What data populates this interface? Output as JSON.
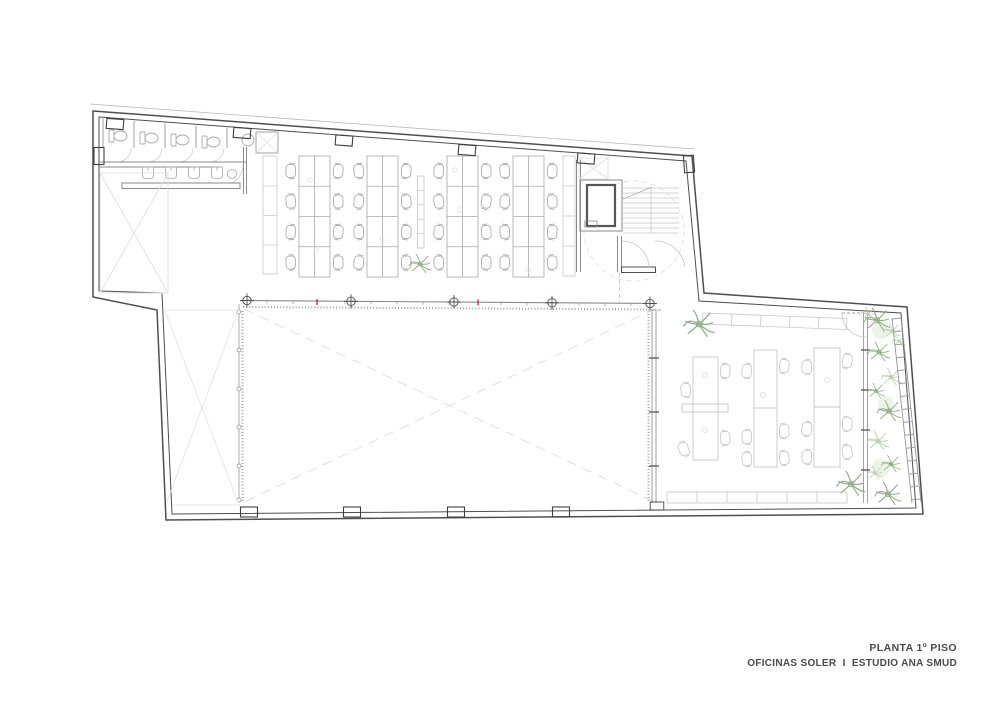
{
  "title_block": {
    "line1": "PLANTA 1º PISO",
    "line2": "OFICINAS SOLER  I  ESTUDIO ANA SMUD"
  },
  "colors": {
    "background": "#ffffff",
    "wall_dark": "#4f4f4f",
    "wall_medium": "#8a8a8a",
    "furniture_medium": "#a9a9a9",
    "furniture_light": "#c7c7c7",
    "void_line": "#e0e0e0",
    "glazing_dot": "#9f9f9f",
    "plant_green": "#8fae85",
    "plant_green_light": "#b9cfae",
    "plant_fill": "#ecf3e7",
    "marker_red": "#cc2222",
    "text_gray": "#4a4a4a"
  }
}
